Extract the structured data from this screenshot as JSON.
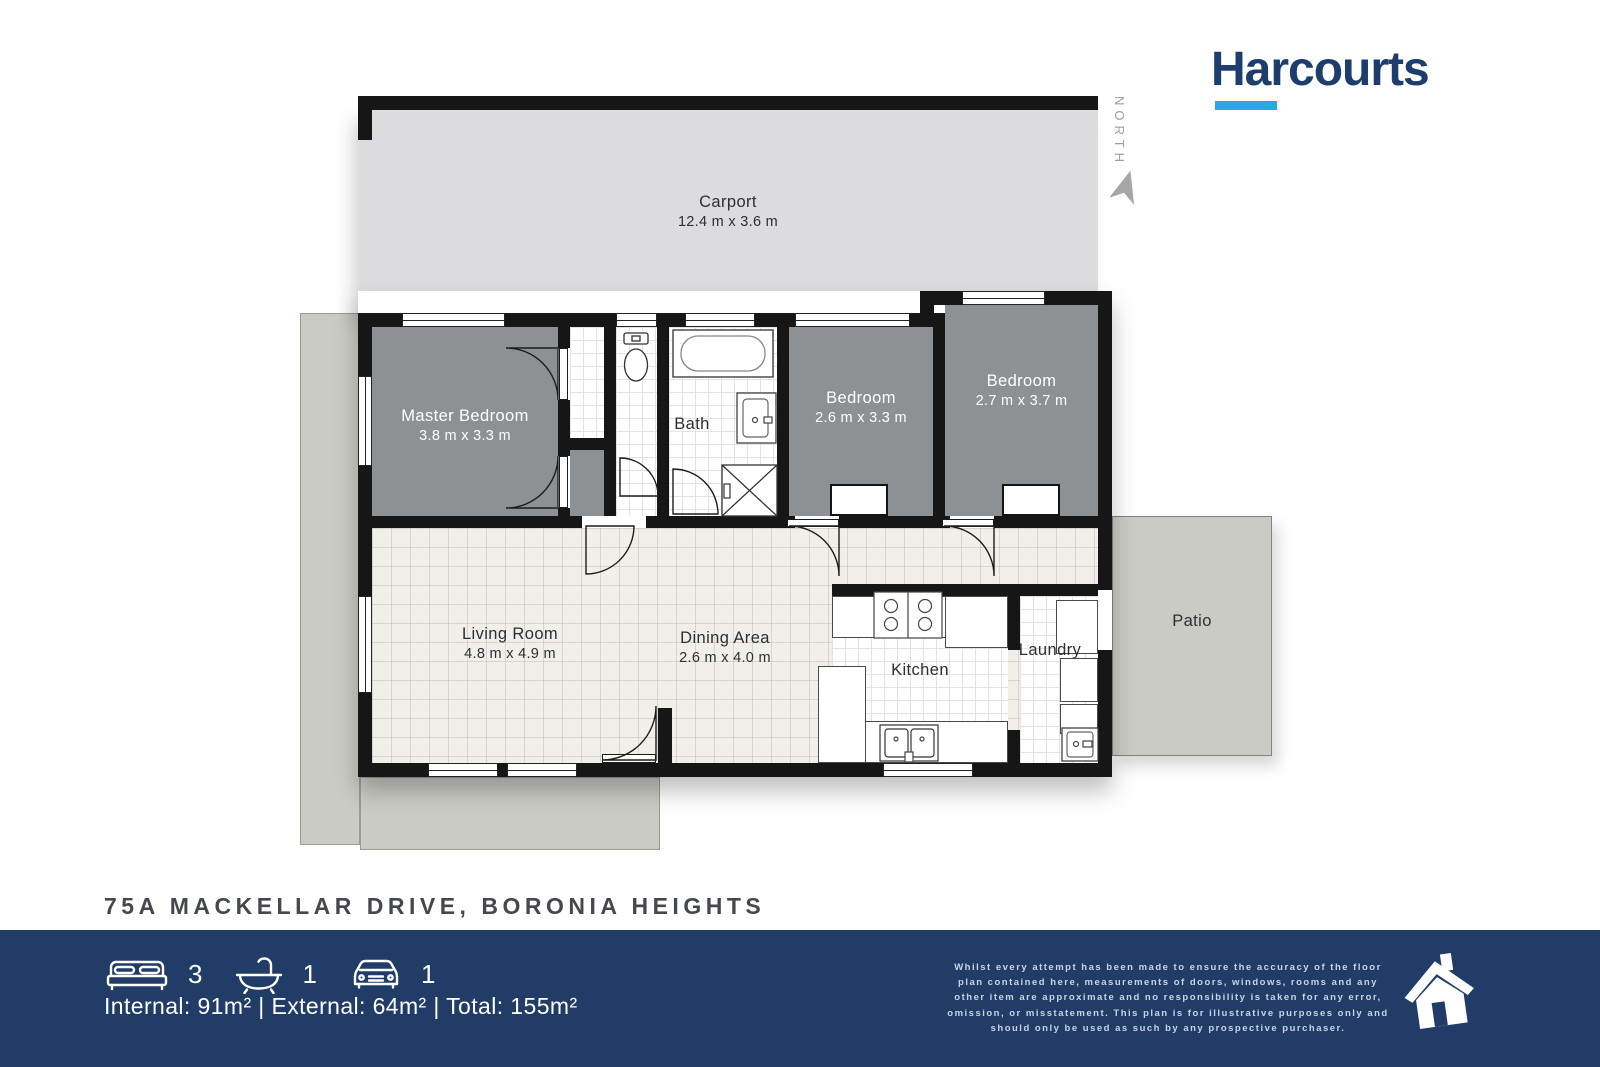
{
  "brand": {
    "logo_text": "Harcourts",
    "navy": "#1d3d6d",
    "cyan": "#29aadf"
  },
  "north_label": "NORTH",
  "rooms": {
    "carport": {
      "name": "Carport",
      "dims": "12.4 m x 3.6 m"
    },
    "master": {
      "name": "Master Bedroom",
      "dims": "3.8 m x 3.3 m"
    },
    "bath": {
      "name": "Bath"
    },
    "bedroom_middle": {
      "name": "Bedroom",
      "dims": "2.6 m x 3.3 m"
    },
    "bedroom_right": {
      "name": "Bedroom",
      "dims": "2.7 m x 3.7 m"
    },
    "living": {
      "name": "Living Room",
      "dims": "4.8 m x 4.9 m"
    },
    "dining": {
      "name": "Dining Area",
      "dims": "2.6 m x 4.0 m"
    },
    "kitchen": {
      "name": "Kitchen"
    },
    "laundry": {
      "name": "Laundry"
    },
    "patio": {
      "name": "Patio"
    }
  },
  "address": "75A MACKELLAR DRIVE, BORONIA HEIGHTS",
  "footer": {
    "bed_count": "3",
    "bath_count": "1",
    "car_count": "1",
    "areas_text": "Internal: 91m² | External: 64m² | Total: 155m²",
    "disclaimer": "Whilst every attempt has been made to ensure the accuracy of the floor plan contained here, measurements of doors, windows, rooms and any other item are approximate and no responsibility is taken for any error, omission, or misstatement. This plan is for illustrative purposes only and should only be used as such by any prospective purchaser.",
    "bar_color": "#223c68"
  }
}
